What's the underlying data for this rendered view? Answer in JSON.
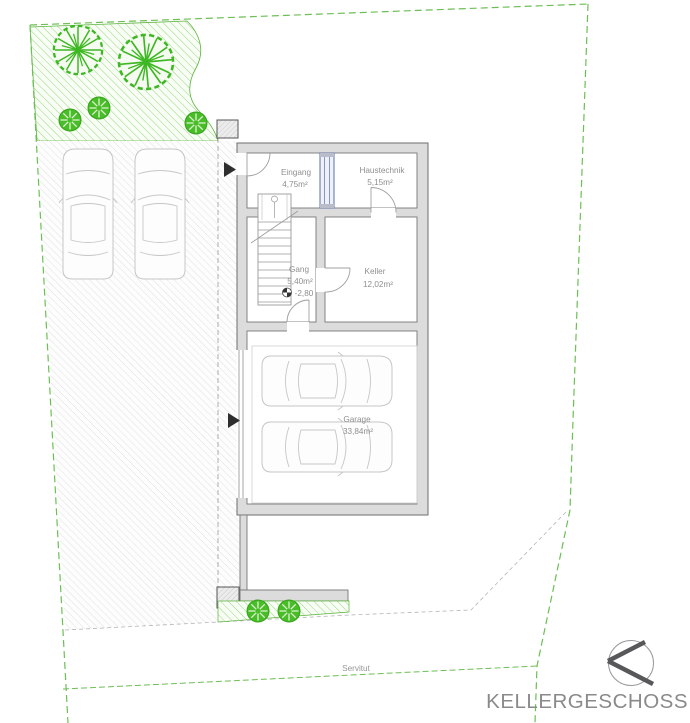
{
  "title": "KELLERGESCHOSS",
  "servitut_label": "Servitut",
  "rooms": [
    {
      "id": "eingang",
      "name": "Eingang",
      "area": "4,75m²"
    },
    {
      "id": "haustechnik",
      "name": "Haustechnik",
      "area": "5,15m²"
    },
    {
      "id": "gang",
      "name": "Gang",
      "area": "5,40m²",
      "level": "-2,80"
    },
    {
      "id": "keller",
      "name": "Keller",
      "area": "12,02m²"
    },
    {
      "id": "garage",
      "name": "Garage",
      "area": "33,84m²"
    }
  ],
  "colors": {
    "tree_green": "#3eb822",
    "boundary_green": "#6cbf54",
    "wall_gray": "#dcdcdc",
    "text_gray": "#8f8f8f",
    "window_blue": "#5f6fa5"
  }
}
